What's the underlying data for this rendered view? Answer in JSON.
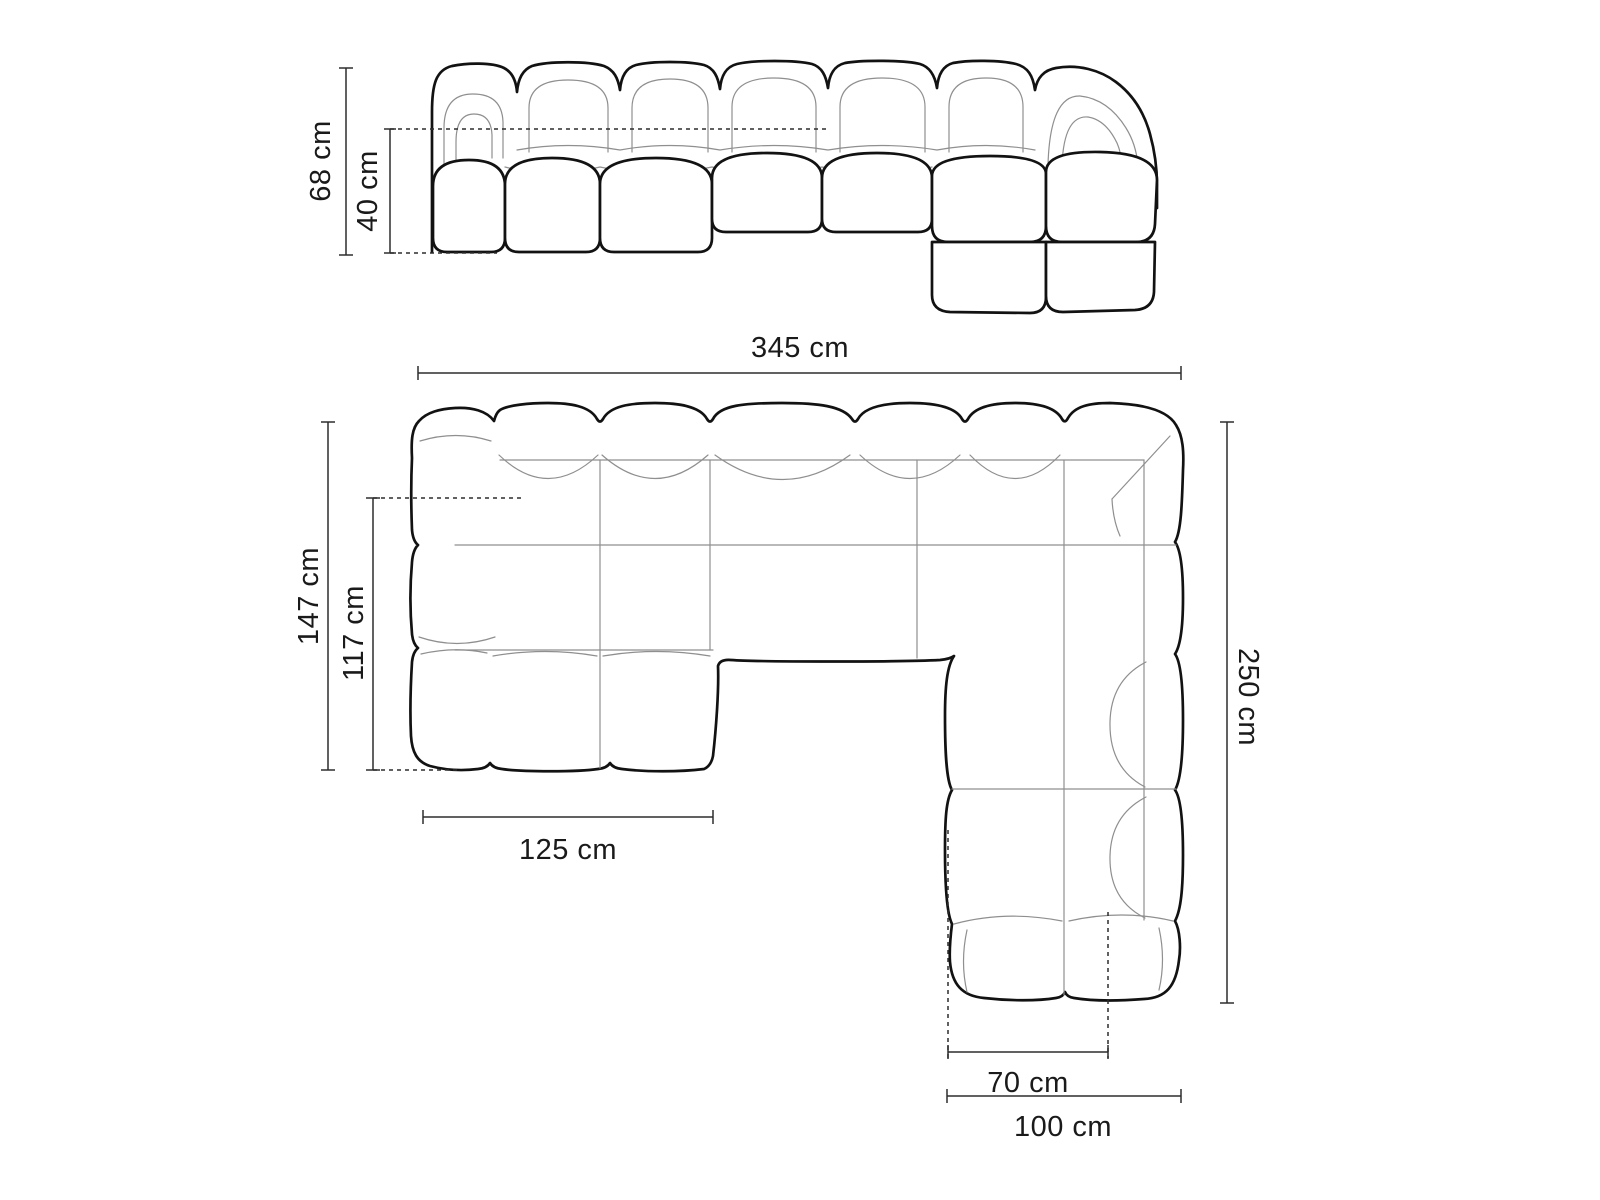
{
  "diagram": {
    "type": "sofa-dimension-drawing",
    "views": {
      "front_view": "front elevation",
      "plan_view": "top plan"
    }
  },
  "colors": {
    "background": "#ffffff",
    "outline": "#121212",
    "seam": "#8f8f8f",
    "dimension": "#2d2d2d",
    "text": "#1a1a1a"
  },
  "dims": {
    "height_total": "68 cm",
    "seat_height": "40 cm",
    "width_total": "345 cm",
    "depth_total": "147 cm",
    "seat_depth": "117 cm",
    "chaise_width": "125 cm",
    "right_length": "250 cm",
    "right_seat_width": "70 cm",
    "right_module_width": "100 cm"
  }
}
